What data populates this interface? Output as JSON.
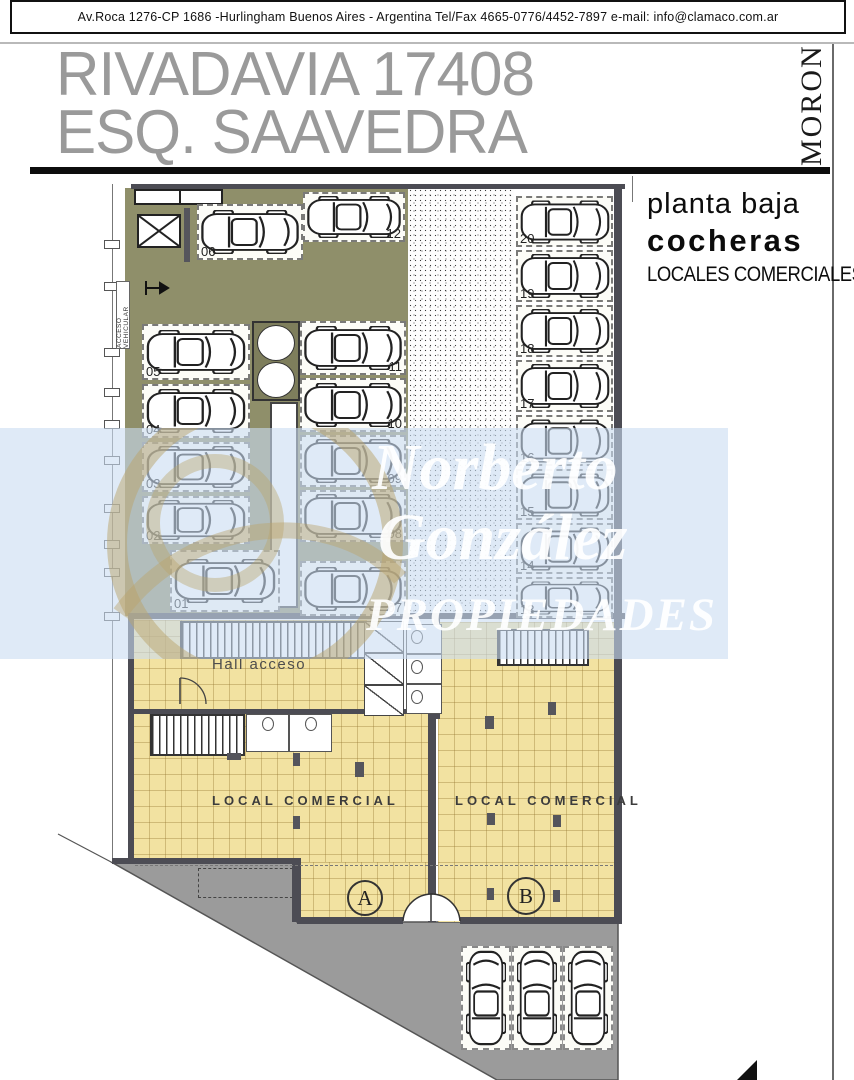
{
  "header": {
    "address_line": "Av.Roca 1276-CP 1686 -Hurlingham Buenos Aires - Argentina  Tel/Fax 4665-0776/4452-7897  e-mail: info@clamaco.com.ar"
  },
  "title": {
    "line1": "RIVADAVIA 17408",
    "line2": "ESQ.  SAAVEDRA",
    "side_label": "MORON"
  },
  "annotation": {
    "line1": "planta baja",
    "line2": "cocheras",
    "line3": "LOCALES COMERCIALES"
  },
  "plan": {
    "labels": {
      "acceso": "ACCESO VEHICULAR",
      "hall": "Hall acceso",
      "local_a": "LOCAL COMERCIAL",
      "local_b": "LOCAL COMERCIAL",
      "unit_a": "A",
      "unit_b": "B"
    },
    "garage_stalls": [
      {
        "label": "06",
        "x": 197,
        "y": 204,
        "w": 106,
        "h": 56,
        "dir": "h",
        "num": "bl"
      },
      {
        "label": "12",
        "x": 303,
        "y": 192,
        "w": 102,
        "h": 50,
        "dir": "h",
        "num": "br"
      },
      {
        "label": "05",
        "x": 142,
        "y": 324,
        "w": 108,
        "h": 56,
        "dir": "h",
        "num": "bl"
      },
      {
        "label": "04",
        "x": 142,
        "y": 384,
        "w": 108,
        "h": 54,
        "dir": "h",
        "num": "bl"
      },
      {
        "label": "03",
        "x": 142,
        "y": 442,
        "w": 108,
        "h": 50,
        "dir": "h",
        "num": "bl"
      },
      {
        "label": "02",
        "x": 142,
        "y": 496,
        "w": 108,
        "h": 48,
        "dir": "h",
        "num": "bl"
      },
      {
        "label": "01",
        "x": 170,
        "y": 550,
        "w": 110,
        "h": 62,
        "dir": "h",
        "num": "bl"
      },
      {
        "label": "11",
        "x": 300,
        "y": 321,
        "w": 106,
        "h": 54,
        "dir": "h",
        "num": "br"
      },
      {
        "label": "10",
        "x": 300,
        "y": 378,
        "w": 106,
        "h": 54,
        "dir": "h",
        "num": "br"
      },
      {
        "label": "09",
        "x": 300,
        "y": 435,
        "w": 106,
        "h": 52,
        "dir": "h",
        "num": "br"
      },
      {
        "label": "08",
        "x": 300,
        "y": 490,
        "w": 106,
        "h": 52,
        "dir": "h",
        "num": "br"
      },
      {
        "label": "07",
        "x": 300,
        "y": 561,
        "w": 106,
        "h": 55,
        "dir": "h",
        "num": "br"
      },
      {
        "label": "20",
        "x": 516,
        "y": 196,
        "w": 97,
        "h": 51,
        "dir": "h",
        "num": "bl"
      },
      {
        "label": "19",
        "x": 516,
        "y": 250,
        "w": 97,
        "h": 52,
        "dir": "h",
        "num": "bl"
      },
      {
        "label": "18",
        "x": 516,
        "y": 305,
        "w": 97,
        "h": 52,
        "dir": "h",
        "num": "bl"
      },
      {
        "label": "17",
        "x": 516,
        "y": 360,
        "w": 97,
        "h": 52,
        "dir": "h",
        "num": "bl"
      },
      {
        "label": "16",
        "x": 516,
        "y": 415,
        "w": 97,
        "h": 51,
        "dir": "h",
        "num": "bl"
      },
      {
        "label": "15",
        "x": 516,
        "y": 469,
        "w": 97,
        "h": 51,
        "dir": "h",
        "num": "bl"
      },
      {
        "label": "14",
        "x": 516,
        "y": 523,
        "w": 97,
        "h": 51,
        "dir": "h",
        "num": "bl"
      },
      {
        "label": "13",
        "x": 516,
        "y": 577,
        "w": 97,
        "h": 41,
        "dir": "h",
        "num": "bl"
      }
    ],
    "street_stalls": [
      {
        "x": 461,
        "y": 946,
        "w": 50,
        "h": 104
      },
      {
        "x": 512,
        "y": 946,
        "w": 50,
        "h": 104
      },
      {
        "x": 563,
        "y": 946,
        "w": 50,
        "h": 104
      }
    ]
  },
  "watermark": {
    "line1": "Norberto",
    "line2": "González",
    "line3": "PROPIEDADES"
  },
  "colors": {
    "drive_olive": "#8f8f6a",
    "floor_tile_yellow": "#f2e2a1",
    "sidewalk_gray": "#9b9b9b",
    "wall_dark": "#4c4c54",
    "title_gray": "#9a9a9a",
    "watermark_blue": "rgba(201,220,242,0.6)",
    "watermark_text": "#ffffff"
  }
}
